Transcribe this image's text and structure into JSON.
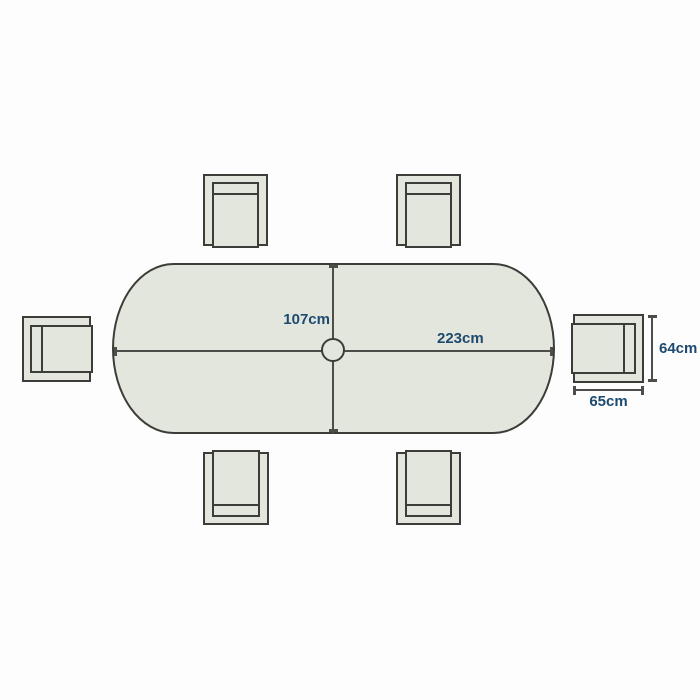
{
  "colors": {
    "background": "#fdfdfd",
    "surface": "#e3e6dd",
    "outline": "#3c3d38",
    "dimension": "#4d4e49",
    "label": "#1d4a6e"
  },
  "table": {
    "length_label": "223cm",
    "width_label": "107cm"
  },
  "chair": {
    "width_label": "65cm",
    "depth_label": "64cm"
  }
}
